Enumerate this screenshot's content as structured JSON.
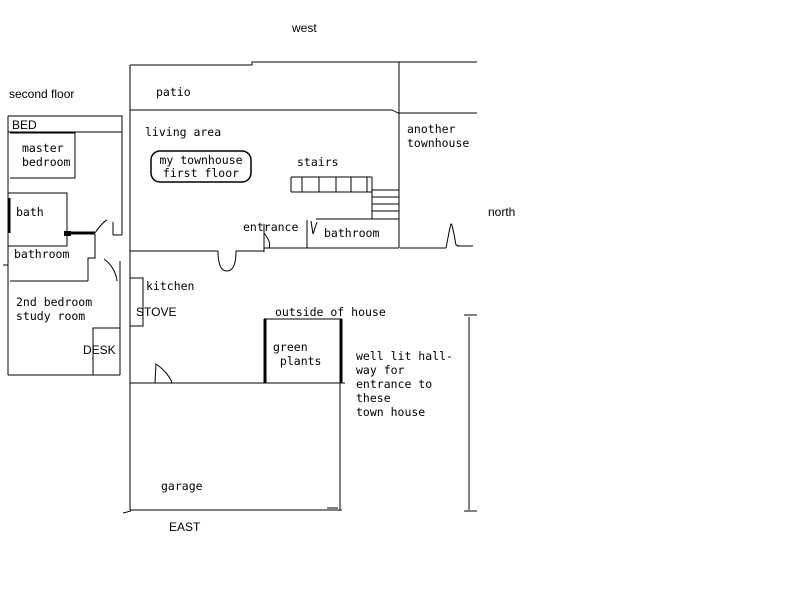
{
  "canvas": {
    "background": "#ffffff",
    "ink": "#000000"
  },
  "compass": {
    "west": "west",
    "north": "north",
    "east": "EAST"
  },
  "second_floor": {
    "title": "second floor",
    "bed": "BED",
    "master_bedroom": "master\nbedroom",
    "bath": "bath",
    "bathroom": "bathroom",
    "bedroom2": "2nd bedroom\nstudy room",
    "desk": "DESK"
  },
  "first_floor": {
    "patio": "patio",
    "living_area": "living area",
    "bubble": "my townhouse\nfirst floor",
    "stairs": "stairs",
    "entrance": "entrance",
    "bathroom": "bathroom",
    "kitchen": "kitchen",
    "stove": "STOVE",
    "outside": "outside of house",
    "green_plants": "green\n plants",
    "garage": "garage"
  },
  "neighbor": {
    "another_townhouse": "another\ntownhouse",
    "hallway_note": "well lit hall-\nway for\nentrance to\nthese\ntown house"
  }
}
